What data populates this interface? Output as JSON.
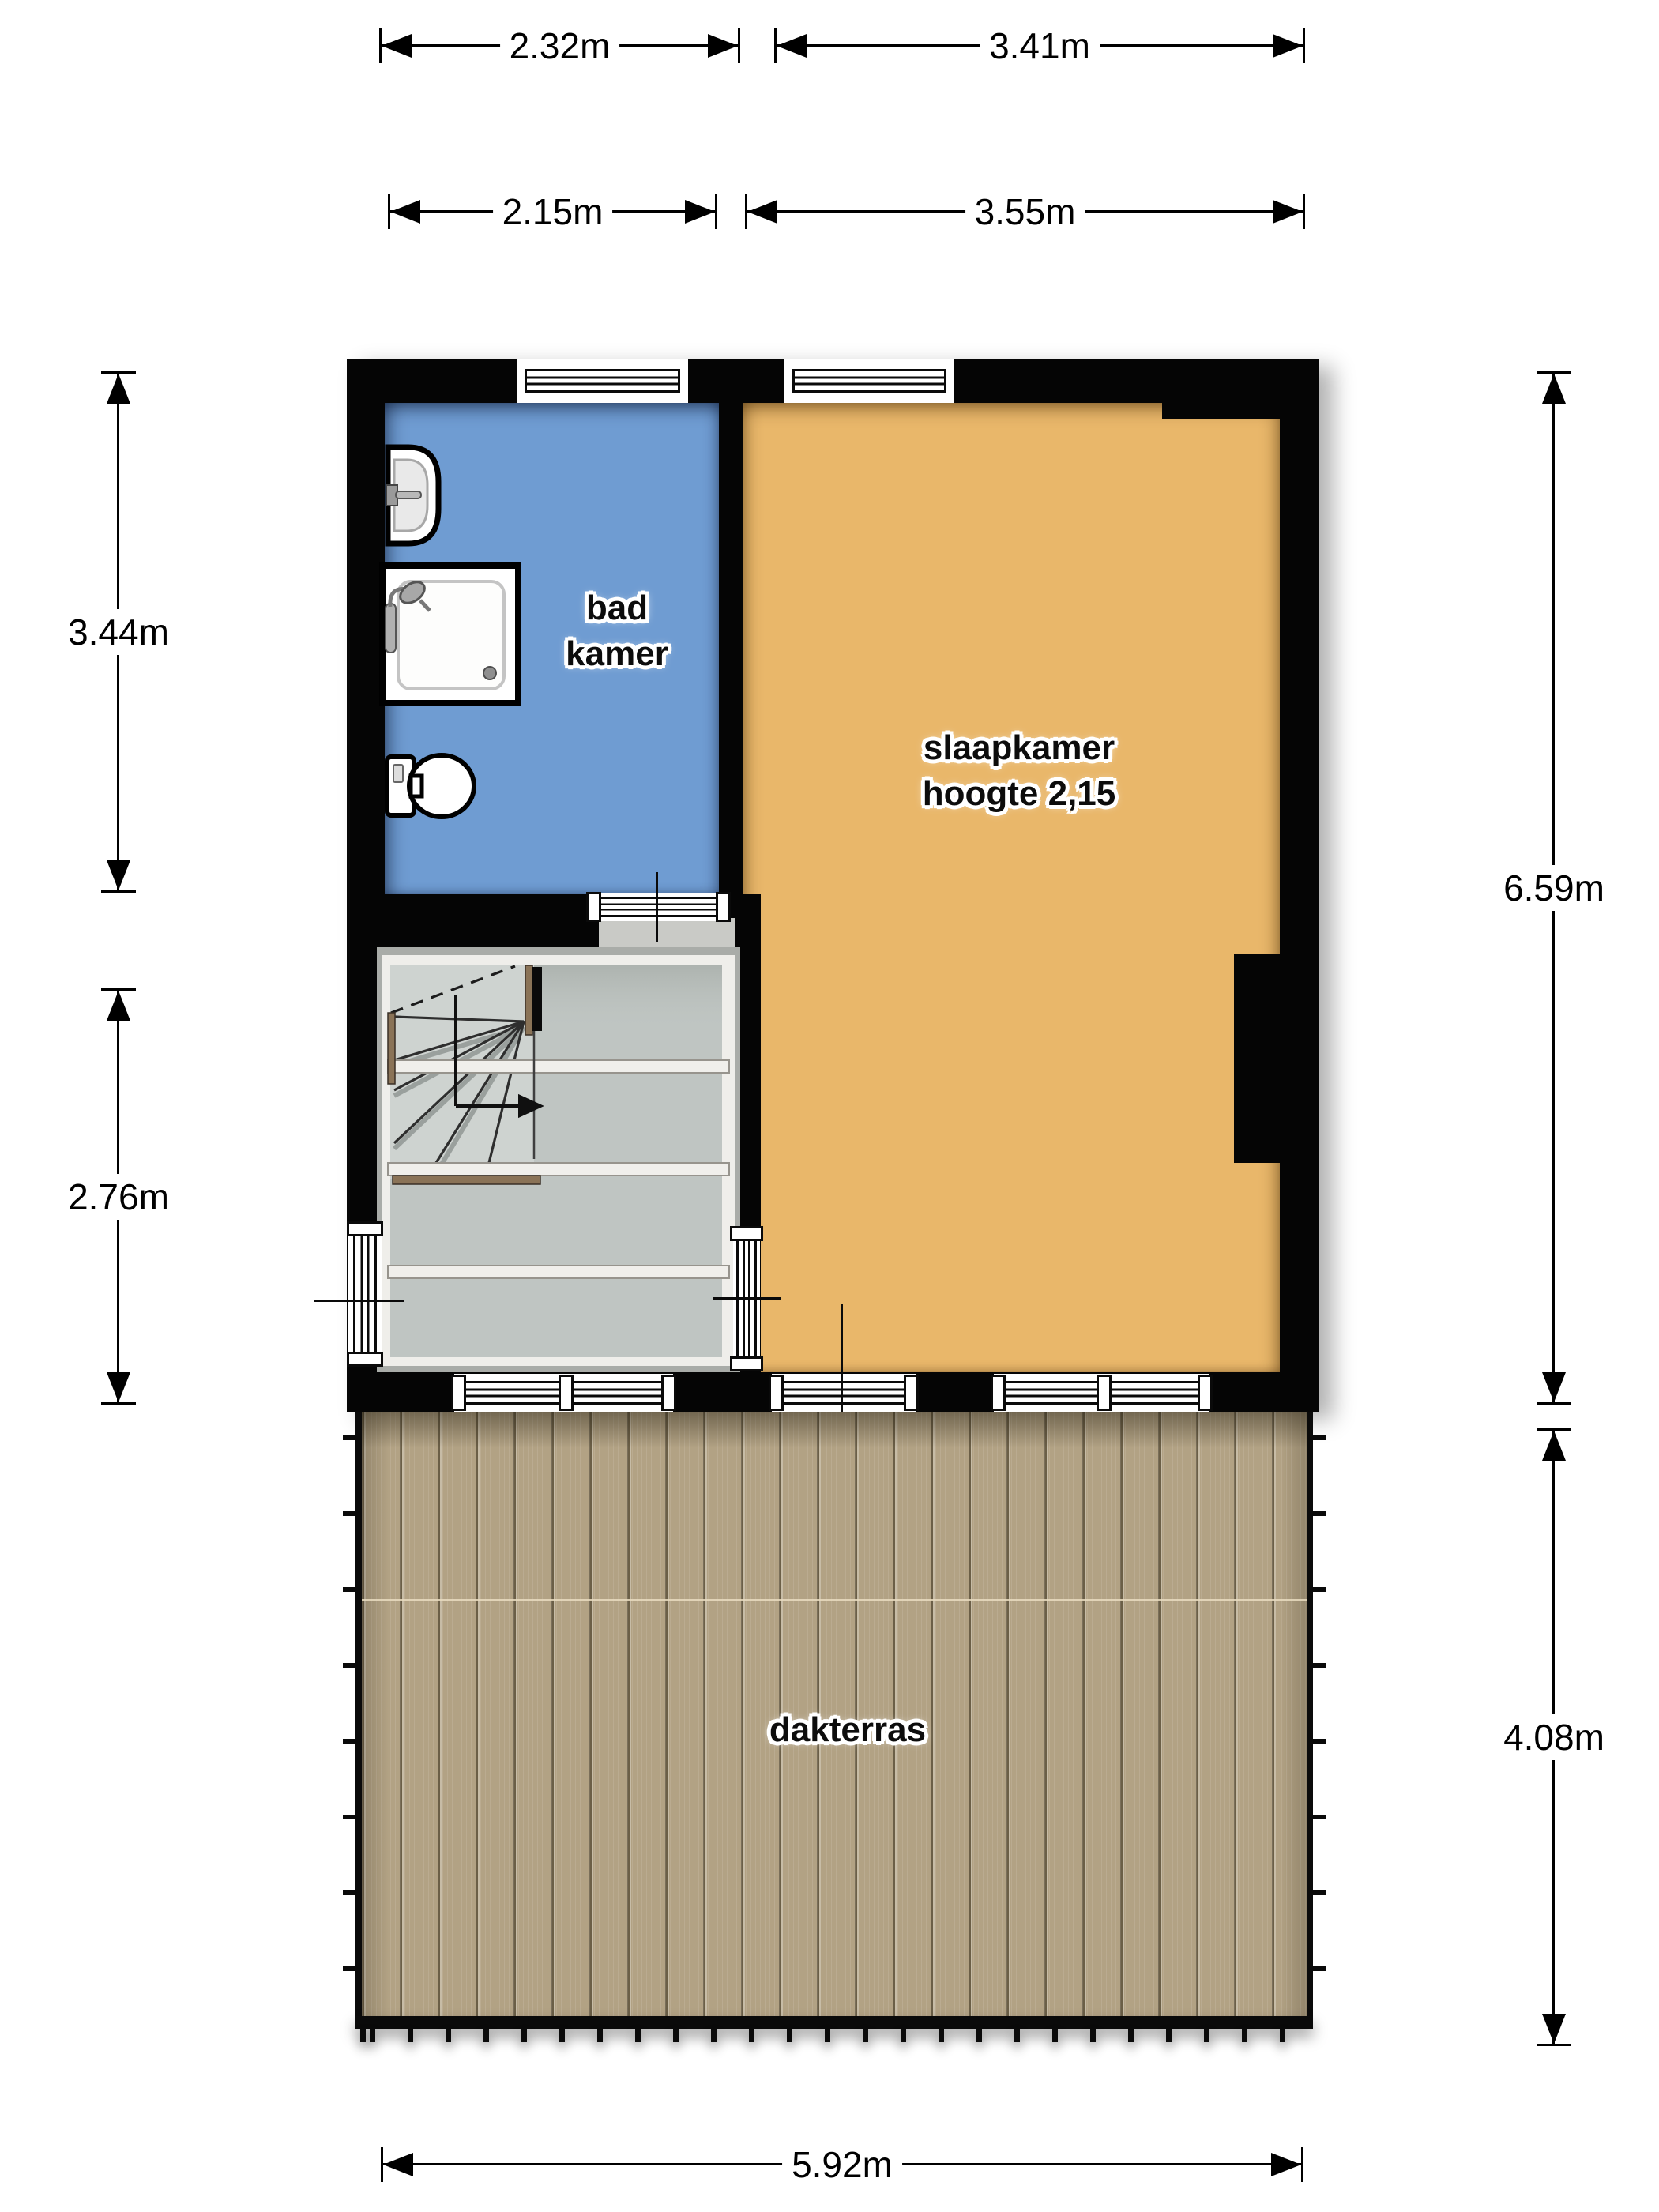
{
  "plan": {
    "rooms": {
      "bathroom": {
        "lines": [
          "bad",
          "kamer"
        ],
        "color": "#6f9cd2"
      },
      "bedroom": {
        "lines": [
          "slaapkamer",
          "hoogte 2,15"
        ],
        "color": "#e9b76a"
      },
      "stairwell": {
        "lines": [],
        "color": "#c5cbc8"
      },
      "roof_terrace": {
        "lines": [
          "dakterras"
        ],
        "color": "#b2a284"
      }
    },
    "dimensions": {
      "top_outer": [
        "2.32m",
        "3.41m"
      ],
      "top_inner": [
        "2.15m",
        "3.55m"
      ],
      "left": [
        "3.44m",
        "2.76m"
      ],
      "right": [
        "6.59m",
        "4.08m"
      ],
      "bottom": [
        "5.92m"
      ]
    },
    "fixtures": [
      "sink",
      "shower",
      "toilet",
      "staircase"
    ],
    "colors": {
      "wall": "#050505",
      "window_frame": "#ffffff",
      "dimension": "#000000",
      "stair_wood": "#8a7357",
      "deck_line": "#6b5f47"
    }
  }
}
